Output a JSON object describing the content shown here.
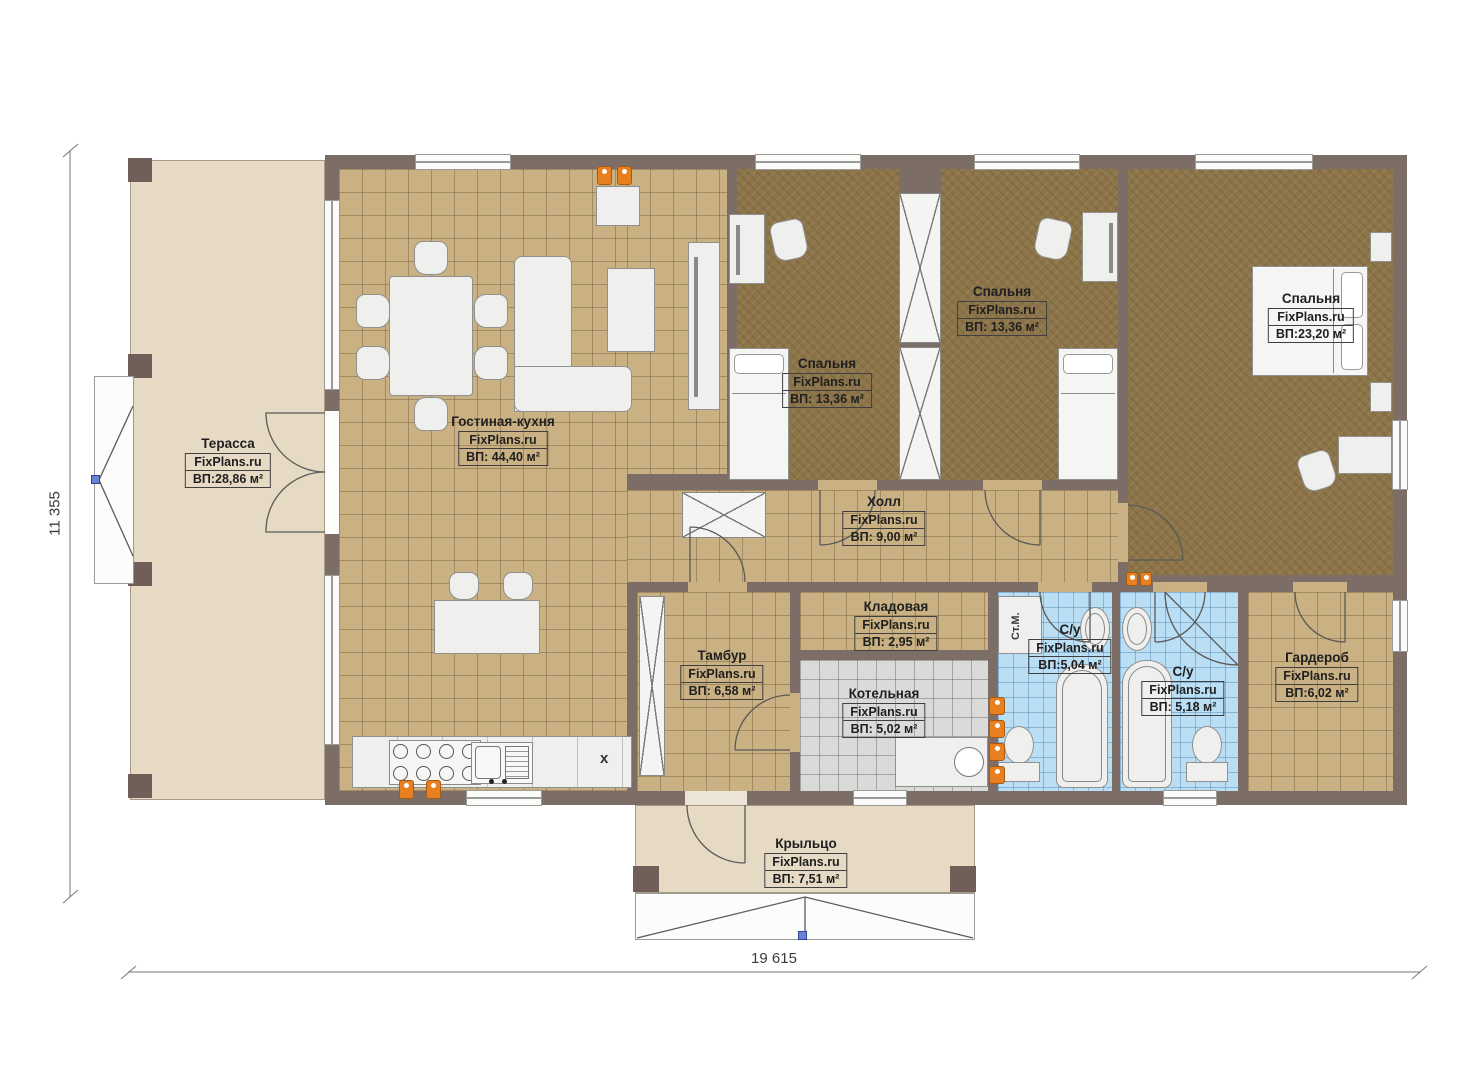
{
  "plan": {
    "brand": "FixPlans.ru",
    "dimensions": {
      "height": "11 355",
      "width": "19 615"
    },
    "rooms": [
      {
        "id": "terrace",
        "name": "Терасса",
        "brand": "FixPlans.ru",
        "area": "ВП:28,86 м²"
      },
      {
        "id": "living-kitchen",
        "name": "Гостиная-кухня",
        "brand": "FixPlans.ru",
        "area": "ВП: 44,40 м²"
      },
      {
        "id": "bedroom-1",
        "name": "Спальня",
        "brand": "FixPlans.ru",
        "area": "ВП: 13,36 м²"
      },
      {
        "id": "bedroom-2",
        "name": "Спальня",
        "brand": "FixPlans.ru",
        "area": "ВП: 13,36 м²"
      },
      {
        "id": "bedroom-3",
        "name": "Спальня",
        "brand": "FixPlans.ru",
        "area": "ВП:23,20 м²"
      },
      {
        "id": "hall",
        "name": "Холл",
        "brand": "FixPlans.ru",
        "area": "ВП: 9,00 м²"
      },
      {
        "id": "storage",
        "name": "Кладовая",
        "brand": "FixPlans.ru",
        "area": "ВП: 2,95 м²"
      },
      {
        "id": "vestibule",
        "name": "Тамбур",
        "brand": "FixPlans.ru",
        "area": "ВП: 6,58 м²"
      },
      {
        "id": "boiler-room",
        "name": "Котельная",
        "brand": "FixPlans.ru",
        "area": "ВП: 5,02 м²"
      },
      {
        "id": "bathroom-1",
        "name": "С/у",
        "brand": "FixPlans.ru",
        "area": "ВП:5,04 м²"
      },
      {
        "id": "bathroom-2",
        "name": "С/у",
        "brand": "FixPlans.ru",
        "area": "ВП: 5,18 м²"
      },
      {
        "id": "wardrobe",
        "name": "Гардероб",
        "brand": "FixPlans.ru",
        "area": "ВП:6,02 м²"
      },
      {
        "id": "porch",
        "name": "Крыльцо",
        "brand": "FixPlans.ru",
        "area": "ВП: 7,51 м²"
      }
    ],
    "annotations": {
      "washing_machine": "Ст.М.",
      "dishwasher_mark": "x"
    },
    "colors": {
      "wall": "#7d6d67",
      "tile_tan": "#c9b183",
      "carpet_brown": "#8d7549",
      "tile_blue": "#badef4",
      "tile_gray": "#dadad8",
      "terrace_beige": "#e7dac5",
      "heater_orange": "#e8801f",
      "marker_blue": "#6b83d6"
    }
  }
}
